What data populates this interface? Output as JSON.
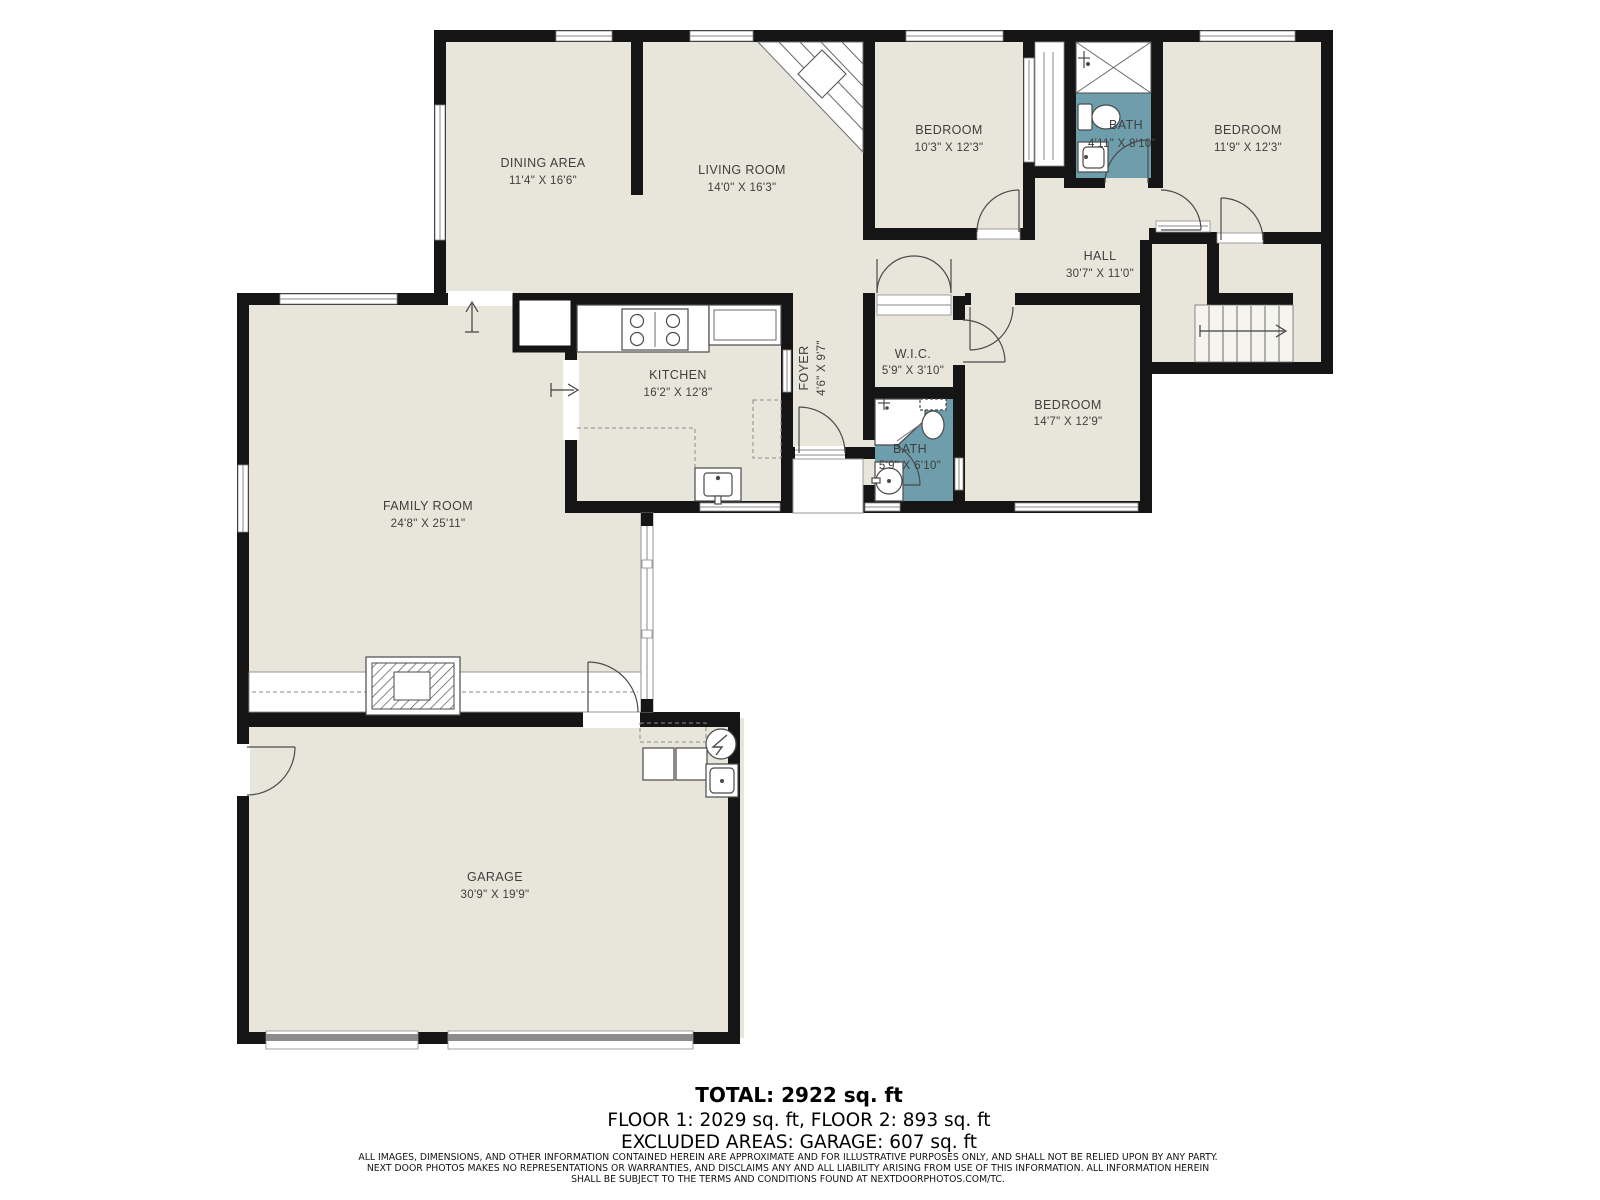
{
  "rooms": {
    "dining": {
      "name": "DINING AREA",
      "dims": "11'4\" X 16'6\""
    },
    "living": {
      "name": "LIVING ROOM",
      "dims": "14'0\" X 16'3\""
    },
    "bedroom_top_left": {
      "name": "BEDROOM",
      "dims": "10'3\" X 12'3\""
    },
    "bath_upper": {
      "name": "BATH",
      "dims": "4'11\" X 8'10\""
    },
    "bedroom_top_right": {
      "name": "BEDROOM",
      "dims": "11'9\" X 12'3\""
    },
    "hall": {
      "name": "HALL",
      "dims": "30'7\" X 11'0\""
    },
    "kitchen": {
      "name": "KITCHEN",
      "dims": "16'2\" X 12'8\""
    },
    "foyer": {
      "name": "FOYER",
      "dims": "4'6\" X 9'7\""
    },
    "wic": {
      "name": "W.I.C.",
      "dims": "5'9\" X 3'10\""
    },
    "bath_middle": {
      "name": "BATH",
      "dims": "5'9\" X 6'10\""
    },
    "bedroom_middle": {
      "name": "BEDROOM",
      "dims": "14'7\" X 12'9\""
    },
    "family": {
      "name": "FAMILY ROOM",
      "dims": "24'8\" X 25'11\""
    },
    "garage": {
      "name": "GARAGE",
      "dims": "30'9\" X 19'9\""
    }
  },
  "summary": {
    "total": "TOTAL: 2922 sq. ft",
    "floors": "FLOOR 1: 2029 sq. ft, FLOOR 2: 893 sq. ft",
    "excluded": "EXCLUDED AREAS: GARAGE: 607 sq. ft"
  },
  "disclaimer": {
    "line1": "ALL IMAGES, DIMENSIONS, AND OTHER INFORMATION CONTAINED HEREIN ARE APPROXIMATE AND FOR ILLUSTRATIVE PURPOSES ONLY, AND SHALL NOT BE RELIED UPON BY ANY PARTY.",
    "line2": "NEXT DOOR PHOTOS MAKES NO REPRESENTATIONS OR WARRANTIES, AND DISCLAIMS ANY AND ALL LIABILITY ARISING FROM USE OF THIS INFORMATION. ALL INFORMATION HEREIN",
    "line3": "SHALL BE SUBJECT TO THE TERMS AND CONDITIONS FOUND AT NEXTDOORPHOTOS.COM/TC."
  },
  "colors": {
    "floor": "#e8e6da",
    "wall": "#151515",
    "bath_accent": "#6e9eac",
    "exterior": "#ffffff"
  }
}
